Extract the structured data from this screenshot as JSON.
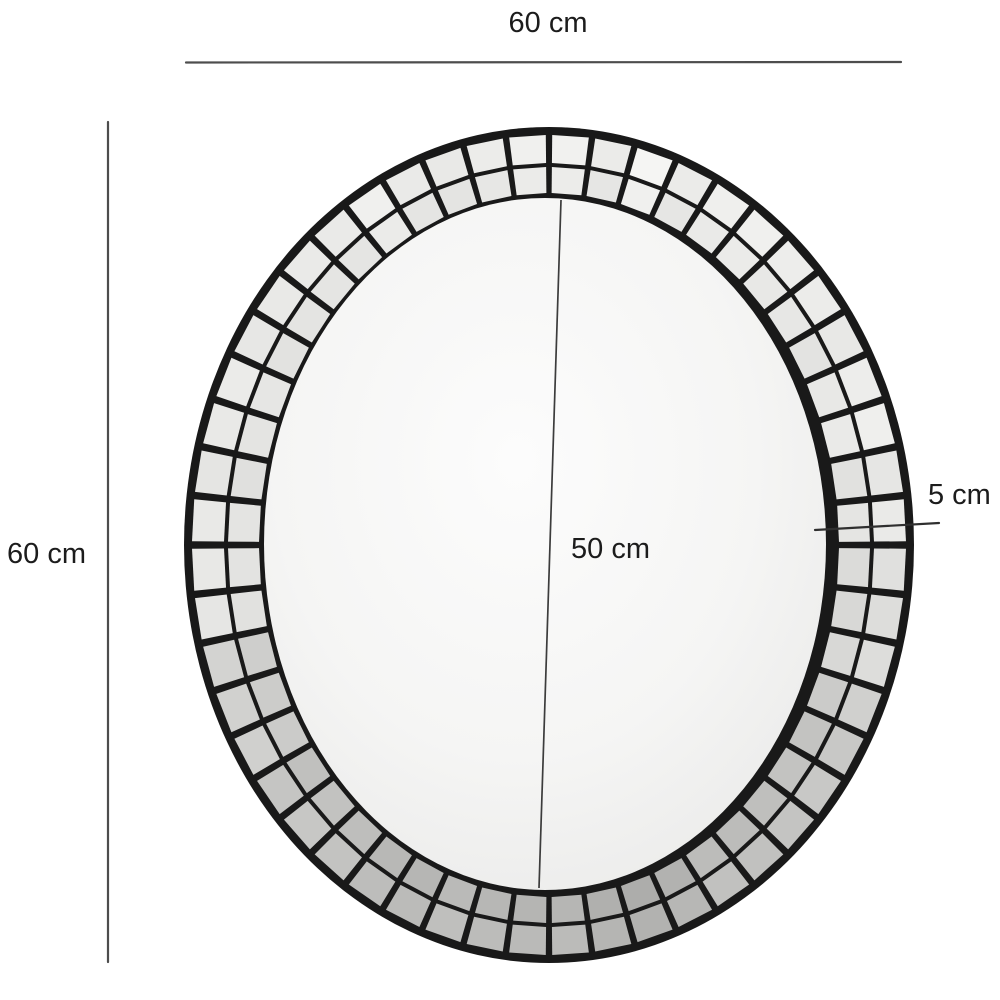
{
  "figure": {
    "background": "#ffffff",
    "description_labels": {
      "overall_width": "60 cm",
      "overall_height": "60 cm",
      "inner_mirror_diameter": "50 cm",
      "frame_border_width": "5 cm"
    }
  },
  "labels": {
    "overall_width": "60 cm",
    "overall_height": "60 cm",
    "inner_mirror_diameter": "50 cm",
    "frame_border_width": "5 cm"
  },
  "colors": {
    "dimension_line": "#4d4d4d",
    "frame_dimension_line": "#2f2f2f",
    "label_text": "#1c1c1c",
    "frame_base": "#191919",
    "tile_gap": "#1b1b1b",
    "tile_lightest": "#f3f3f3",
    "tile_darkest": "#b9b5b2",
    "mirror_center": "#fcfcfc",
    "mirror_edge": "#e2e2e1",
    "seam_line": "#3c3c3c"
  }
}
